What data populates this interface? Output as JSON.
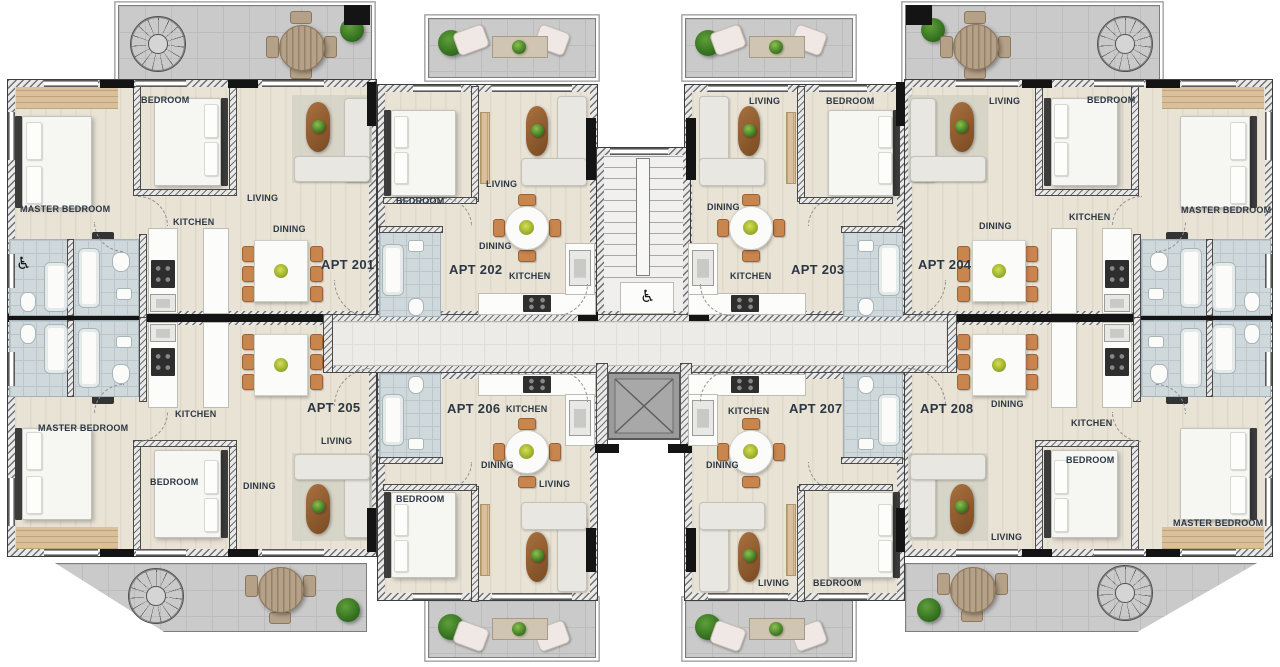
{
  "apartments": [
    {
      "id": "apt-201",
      "label": "APT 201",
      "rooms": [
        "BEDROOM",
        "MASTER BEDROOM",
        "LIVING",
        "KITCHEN",
        "DINING"
      ]
    },
    {
      "id": "apt-202",
      "label": "APT 202",
      "rooms": [
        "BEDROOM",
        "LIVING",
        "DINING",
        "KITCHEN"
      ]
    },
    {
      "id": "apt-203",
      "label": "APT 203",
      "rooms": [
        "LIVING",
        "BEDROOM",
        "DINING",
        "KITCHEN"
      ]
    },
    {
      "id": "apt-204",
      "label": "APT 204",
      "rooms": [
        "LIVING",
        "BEDROOM",
        "DINING",
        "KITCHEN",
        "MASTER BEDROOM"
      ]
    },
    {
      "id": "apt-205",
      "label": "APT 205",
      "rooms": [
        "MASTER BEDROOM",
        "BEDROOM",
        "KITCHEN",
        "DINING",
        "LIVING"
      ]
    },
    {
      "id": "apt-206",
      "label": "APT 206",
      "rooms": [
        "BEDROOM",
        "DINING",
        "KITCHEN",
        "LIVING"
      ]
    },
    {
      "id": "apt-207",
      "label": "APT 207",
      "rooms": [
        "KITCHEN",
        "DINING",
        "LIVING",
        "BEDROOM"
      ]
    },
    {
      "id": "apt-208",
      "label": "APT 208",
      "rooms": [
        "DINING",
        "KITCHEN",
        "BEDROOM",
        "LIVING",
        "MASTER BEDROOM"
      ]
    }
  ],
  "core": {
    "accessible_symbol": "♿",
    "features": [
      "staircase",
      "elevator",
      "corridor",
      "accessible-wc"
    ]
  },
  "outdoor": {
    "features": [
      "roof-terrace",
      "balcony",
      "spiral-staircase",
      "outdoor-dining-set",
      "outdoor-sofa-set",
      "plants"
    ]
  },
  "colors": {
    "floor": "#e9e3d6",
    "terrace_tile": "#cacaca",
    "bath_tile": "#cfd8db",
    "wall_dark": "#3c3c3c",
    "label_text": "#2c3744",
    "wood_accent": "#d9c09b",
    "dining_chair": "#c9854e",
    "coffee_table": "#96602f",
    "elevator_cab": "#9b9b9b",
    "plant_green": "#4e8c2f"
  }
}
